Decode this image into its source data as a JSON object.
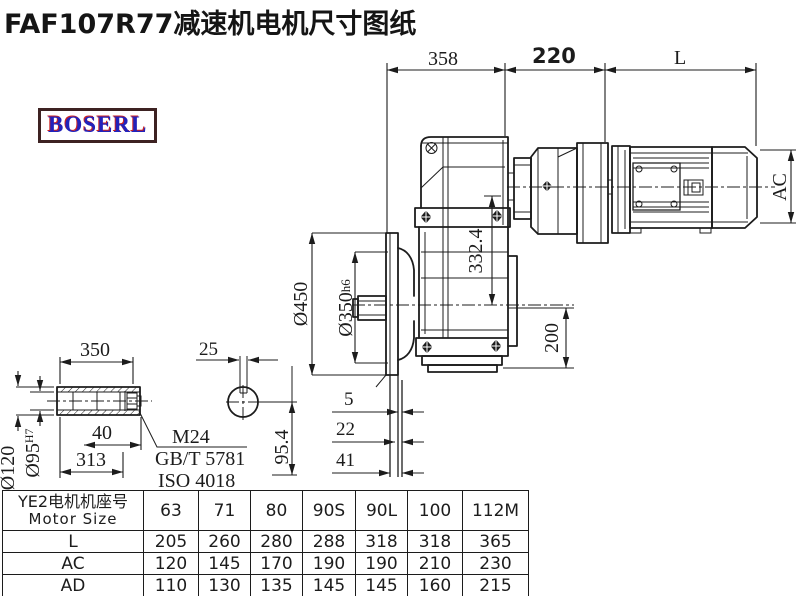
{
  "title": "FAF107R77减速机电机尺寸图纸",
  "logo": {
    "text": "BOSERL"
  },
  "drawing": {
    "dim_358": "358",
    "dim_220": "220",
    "dim_L": "L",
    "dim_AC": "AC",
    "dim_450": "Ø450",
    "dim_350_main": "Ø350",
    "dim_350_suffix": "h6",
    "dim_332_4": "332.4",
    "dim_200": "200",
    "dim_5": "5",
    "dim_22": "22",
    "dim_41": "41",
    "shaft_350": "350",
    "shaft_40": "40",
    "shaft_313": "313",
    "shaft_120": "Ø120",
    "shaft_95_main": "Ø95",
    "shaft_95_suffix": "H7",
    "shaft_25": "25",
    "shaft_95_4": "95.4",
    "note_m24": "M24",
    "note_gbt": "GB/T 5781",
    "note_iso": "ISO 4018"
  },
  "table": {
    "header_cn": "YE2电机机座号",
    "header_en": "Motor Size",
    "columns": [
      "63",
      "71",
      "80",
      "90S",
      "90L",
      "100",
      "112M"
    ],
    "rows": [
      {
        "label": "L",
        "values": [
          "205",
          "260",
          "280",
          "288",
          "318",
          "318",
          "365"
        ]
      },
      {
        "label": "AC",
        "values": [
          "120",
          "145",
          "170",
          "190",
          "190",
          "210",
          "230"
        ]
      },
      {
        "label": "AD",
        "values": [
          "110",
          "130",
          "135",
          "145",
          "145",
          "160",
          "215"
        ]
      }
    ]
  },
  "colors": {
    "line": "#1c1c1c",
    "logo_border": "#3d2222",
    "logo_blue": "#2222bb",
    "logo_red": "#cc2222"
  }
}
